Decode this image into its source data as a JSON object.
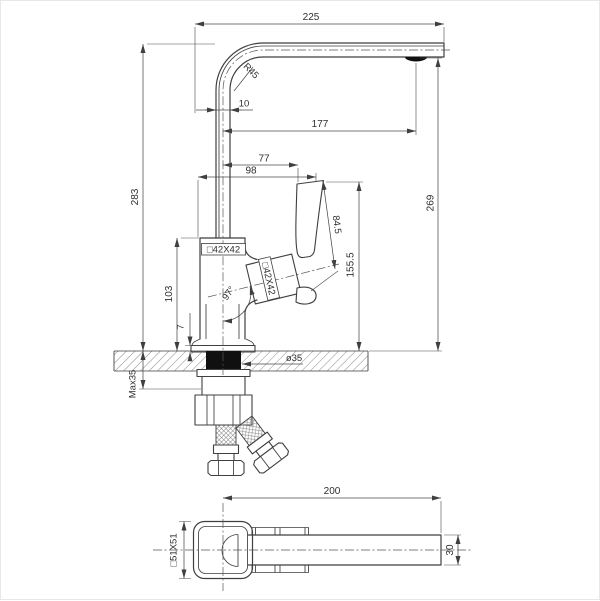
{
  "colors": {
    "line": "#3f3f3f",
    "dimension": "#4a4a4a",
    "text": "#2f2f2f",
    "solid_fill": "#101010",
    "background": "#ffffff"
  },
  "main_view": {
    "dims": {
      "spout_reach": "225",
      "spout_radius": "R45",
      "spout_tube": "10",
      "aerator_offset": "177",
      "handle_offset_front": "77",
      "handle_offset_back": "98",
      "total_height": "283",
      "spout_height": "269",
      "handle_length": "84.5",
      "handle_top_height": "155.5",
      "body_section": "□42X42",
      "handle_section": "□42X42",
      "body_height": "103",
      "handle_angle": "97°",
      "base_plate": "7",
      "hole_diameter": "ø35",
      "max_deck": "Max35"
    }
  },
  "plan_view": {
    "dims": {
      "spout_length": "200",
      "handle_section": "□51X51",
      "spout_width": "30"
    }
  }
}
